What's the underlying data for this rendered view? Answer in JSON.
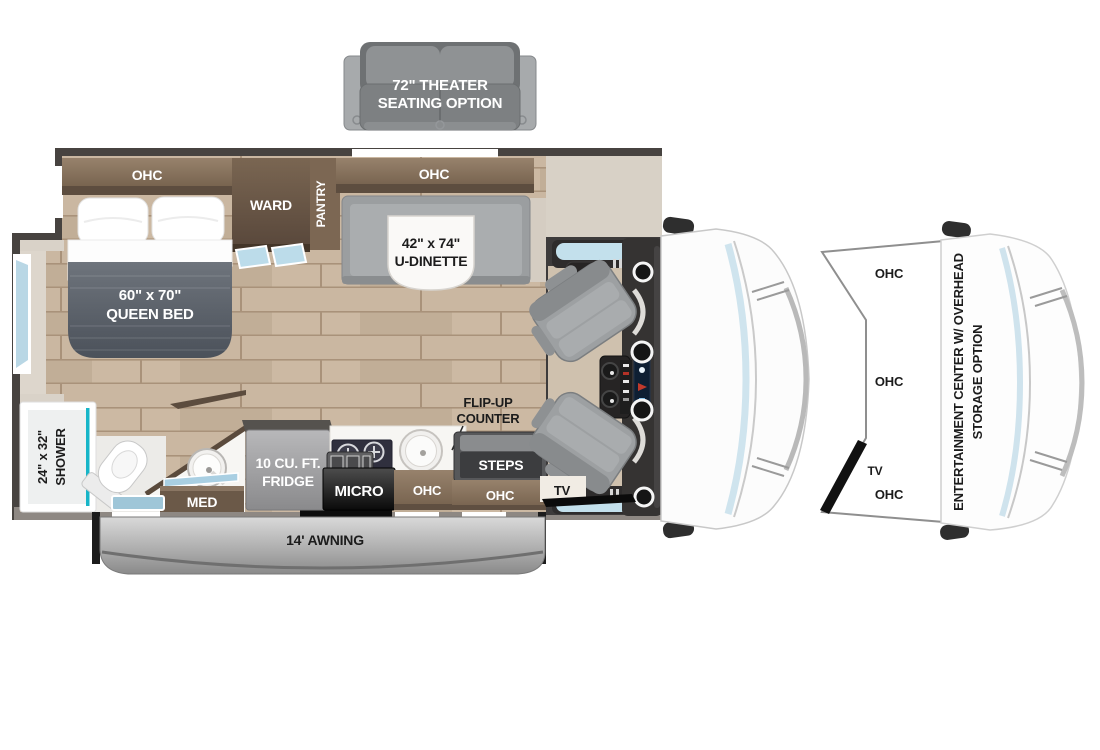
{
  "diagram": {
    "theater": {
      "line1": "72\" THEATER",
      "line2": "SEATING OPTION"
    },
    "bedroom": {
      "ohc": "OHC",
      "ward": "WARD",
      "pantry": "PANTRY",
      "bed_size": "60\" x 70\"",
      "bed_name": "QUEEN BED"
    },
    "dinette": {
      "ohc": "OHC",
      "size": "42\" x 74\"",
      "name": "U-DINETTE"
    },
    "bathroom": {
      "shower_size": "24\" x 32\"",
      "shower_name": "SHOWER",
      "med": "MED"
    },
    "kitchen": {
      "fridge_line1": "10 CU. FT.",
      "fridge_line2": "FRIDGE",
      "micro": "MICRO",
      "ohc": "OHC",
      "flip_line1": "FLIP-UP",
      "flip_line2": "COUNTER"
    },
    "entry": {
      "steps": "STEPS",
      "ohc": "OHC",
      "tv": "TV"
    },
    "exterior": {
      "awning": "14' AWNING"
    },
    "front_option": {
      "ohc_top": "OHC",
      "ohc_mid": "OHC",
      "tv": "TV",
      "ohc_bottom": "OHC",
      "ent_line1": "ENTERTAINMENT CENTER W/ OVERHEAD",
      "ent_line2": "STORAGE OPTION"
    }
  },
  "colors": {
    "wall": "#474340",
    "wood_base": "#c9b6a0",
    "cabinet_brown": "#8a7560",
    "blanket_gray": "#5b616a",
    "glass_blue": "#bcd9e8",
    "accent_teal": "#17b5c8",
    "awning_gray": "#b9b9b9",
    "seat_gray": "#9da0a2"
  }
}
